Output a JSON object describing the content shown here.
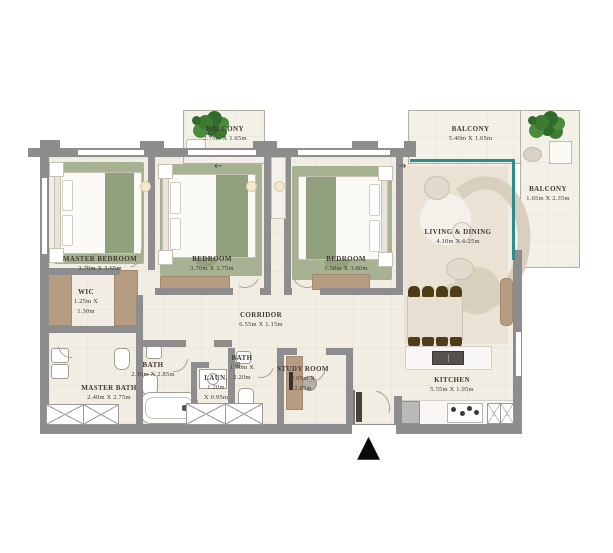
{
  "rooms": [
    {
      "name": "MASTER BEDROOM",
      "l1": "3.70m X 3.65m"
    },
    {
      "name": "BEDROOM",
      "l1": "3.70m X 3.75m"
    },
    {
      "name": "BEDROOM",
      "l1": "3.50m X 3.80m"
    },
    {
      "name": "LIVING & DINING",
      "l1": "4.10m X 6.25m"
    },
    {
      "name": "BALCONY",
      "l1": "2.75m X 1.65m"
    },
    {
      "name": "BALCONY",
      "l1": "5.40m X 1.65m"
    },
    {
      "name": "BALCONY",
      "l1": "1.65m X 2.35m"
    },
    {
      "name": "WIC",
      "l1": "1.25m X",
      "l2": "1.30m"
    },
    {
      "name": "MASTER BATH",
      "l1": "2.40m X 2.75m"
    },
    {
      "name": "BATH",
      "l1": "2.10m X 2.85m"
    },
    {
      "name": "LAUN.",
      "l1": "1.20m",
      "l2": "X 0.95m"
    },
    {
      "name": "BATH",
      "l1": "1.50m X",
      "l2": "2.20m"
    },
    {
      "name": "STUDY ROOM",
      "l1": "2.05m X",
      "l2": "2.85m"
    },
    {
      "name": "CORRIDOR",
      "l1": "6.55m X 1.15m"
    },
    {
      "name": "KITCHEN",
      "l1": "5.55m X 1.95m"
    }
  ],
  "icons": {
    "entrance_marker": "▲",
    "slide_arrow_left": "←",
    "slide_arrow_right": "→"
  },
  "colors": {
    "wall": "#8d8d8d",
    "floor": "#f1ede3",
    "rug_green": "#a7b292",
    "wood": "#b69c80",
    "dining_chair": "#4f3d18",
    "glass_teal": "#2e8c8c",
    "plant": "#3f7a33",
    "sofa": "#d8cfbf",
    "entrance_marker": "#0a0a0a"
  }
}
